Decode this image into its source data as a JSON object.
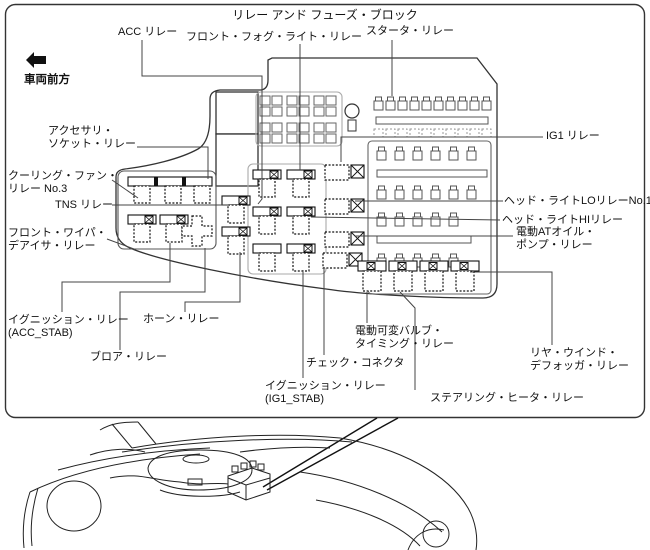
{
  "figure": {
    "title": "リレー アンド フューズ・ブロック",
    "front_direction_label": "車両前方"
  },
  "callouts": {
    "acc_relay": {
      "text": "ACC リレー"
    },
    "front_fog_light_relay": {
      "text": "フロント・フォグ・ライト・リレー"
    },
    "starter_relay": {
      "text": "スタータ・リレー"
    },
    "accessory_socket_relay": {
      "line1": "アクセサリ・",
      "line2": "ソケット・リレー"
    },
    "cooling_fan_relay_no3": {
      "line1": "クーリング・ファン・",
      "line2": "リレー No.3"
    },
    "tns_relay": {
      "text": "TNS リレー"
    },
    "front_wiper_deicer_relay": {
      "line1": "フロント・ワイパ・",
      "line2": "デアイサ・リレー"
    },
    "ignition_relay_acc_stab": {
      "line1": "イグニッション・リレー",
      "line2": "(ACC_STAB)"
    },
    "horn_relay": {
      "text": "ホーン・リレー"
    },
    "blower_relay": {
      "text": "ブロア・リレー"
    },
    "ignition_relay_ig1_stab": {
      "line1": "イグニッション・リレー",
      "line2": "(IG1_STAB)"
    },
    "check_connector": {
      "text": "チェック・コネクタ"
    },
    "electric_variable_valve_timing_relay": {
      "line1": "電動可変バルブ・",
      "line2": "タイミング・リレー"
    },
    "steering_heater_relay": {
      "text": "ステアリング・ヒータ・リレー"
    },
    "rear_window_defogger_relay": {
      "line1": "リヤ・ウインド・",
      "line2": "デフォッガ・リレー"
    },
    "electric_at_oil_pump_relay": {
      "line1": "電動ATオイル・",
      "line2": "ポンプ・リレー"
    },
    "headlight_hi_relay": {
      "text": "ヘッド・ライトHIリレー"
    },
    "headlight_lo_relay_no1": {
      "text": "ヘッド・ライトLOリレーNo.1"
    },
    "ig1_relay": {
      "text": "IG1 リレー"
    }
  },
  "colors": {
    "line": "#1a1a1a",
    "gray_line": "#999999",
    "background": "#ffffff"
  }
}
